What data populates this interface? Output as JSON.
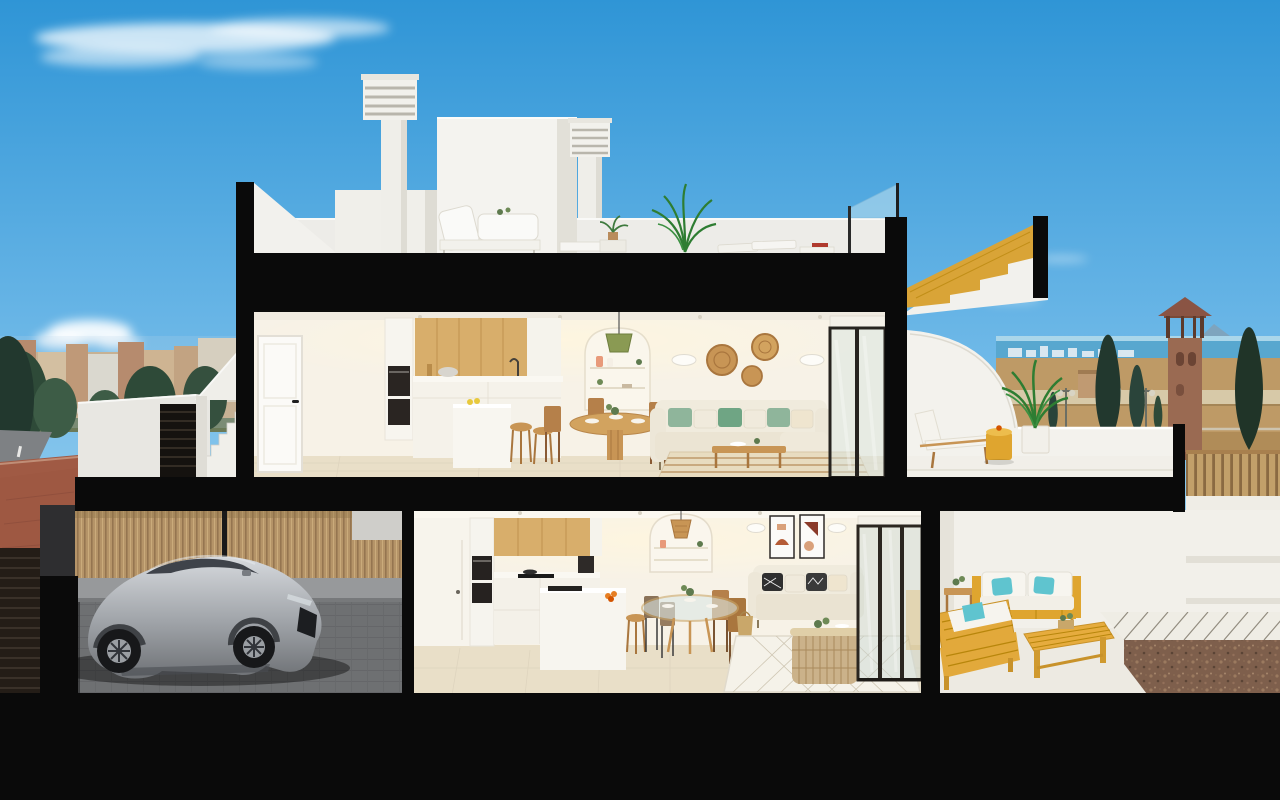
{
  "meta": {
    "title": "3D cutaway cross-section rendering of a two-storey coastal townhouse",
    "image_type": "architectural sectional visualization, no text or UI controls",
    "canvas": "1280x800"
  },
  "palette": {
    "sky_top": "#2F95D6",
    "sky_horizon": "#D6EEFA",
    "cut_black": "#0A0A0A",
    "wall_white": "#F2F1EC",
    "interior_wall": "#F7F2E7",
    "interior_floor": "#E9DFC8",
    "oak_cabinet": "#D8AE6B",
    "stair_wood": "#D9A437",
    "outdoor_wood": "#DFA52F",
    "sofa_cream": "#F0EBDD",
    "cushion_green": "#8FB59B",
    "cushion_teal": "#5FC4CF",
    "car_silver": "#AEB1B6",
    "garage_floor": "#6E7072",
    "bamboo_fence": "#B59468",
    "sidewalk_red": "#A05A44",
    "road_grey": "#7E8184",
    "sea_blue": "#58A7CF",
    "mountain_blue": "#7FA3BC",
    "field_tan": "#BE9A66",
    "tree_green": "#22382E",
    "tower_brick": "#9A6A52",
    "gravel_brown": "#7E5F4C",
    "glass_tint": "#C9D6D2"
  },
  "scene": {
    "sky": {
      "description": "clear blue gradient sky with wispy white clouds",
      "cloud_groups": 3
    },
    "background_left": {
      "items": [
        "low town skyline in warm tones",
        "dark green trees",
        "grey road with lane dash",
        "red paver sidewalk",
        "round blue traffic sign"
      ]
    },
    "background_right": {
      "items": [
        "sea horizon with distant high-rises",
        "blue mountains",
        "brick watchtower with hip roof",
        "cypress trees",
        "dry tan field",
        "light coastal road",
        "street lamps",
        "timber slat fence"
      ]
    },
    "building": {
      "floors": 2,
      "structure_note": "black slabs and jambs mark the section cuts",
      "roof_terrace": {
        "items": [
          "two louvered chimney stacks",
          "white stair bulkhead",
          "white outdoor lounge set",
          "potted plants and tall palm",
          "two flat sun loungers",
          "glass balustrade",
          "sectioned oak staircase wedge"
        ]
      },
      "upper_floor": {
        "entrance": {
          "items": [
            "white panel entrance door",
            "exterior white staircase",
            "dark louvered gate"
          ]
        },
        "kitchen": {
          "items": [
            "oak upper cabinets",
            "tall unit with double oven",
            "white worktop with pots",
            "white peninsula island",
            "two oak bar stools"
          ]
        },
        "dining": {
          "items": [
            "round oak pedestal table",
            "four timber chairs",
            "white place settings",
            "olive pendant lamp",
            "arched shelving niche with vases"
          ]
        },
        "living": {
          "items": [
            "cream corner sofa",
            "green and cream cushions",
            "three rattan wall discs",
            "two wall sconces",
            "oak coffee table",
            "striped beige rug"
          ]
        },
        "terrace": {
          "items": [
            "curved white parapet",
            "timber sun lounger with white cushion",
            "yellow drum side table",
            "potted palm"
          ]
        }
      },
      "ground_floor": {
        "garage": {
          "items": [
            "silver sports coupe",
            "bamboo slat fence",
            "grey paver floor",
            "dark sectional garage door"
          ]
        },
        "kitchen": {
          "items": [
            "oak upper cabinets",
            "double oven tower",
            "black hob",
            "coffee machine",
            "white island with fruit bowl",
            "oak stool"
          ]
        },
        "dining": {
          "items": [
            "round glass table",
            "four mixed chairs",
            "arched niche with rattan pendant"
          ]
        },
        "living": {
          "items": [
            "cream two-seater sofa",
            "monochrome patterned cushions",
            "two abstract art prints",
            "two wall sconces",
            "rattan basket coffee table",
            "diamond-pattern rug",
            "woven floor basket"
          ]
        },
        "patio": {
          "items": [
            "acacia-yellow outdoor sofa set",
            "white cushions with turquoise pillows",
            "slatted bench table with planter",
            "terraced white wall",
            "timber fence",
            "gravel bed with white tile grid"
          ]
        }
      }
    }
  }
}
